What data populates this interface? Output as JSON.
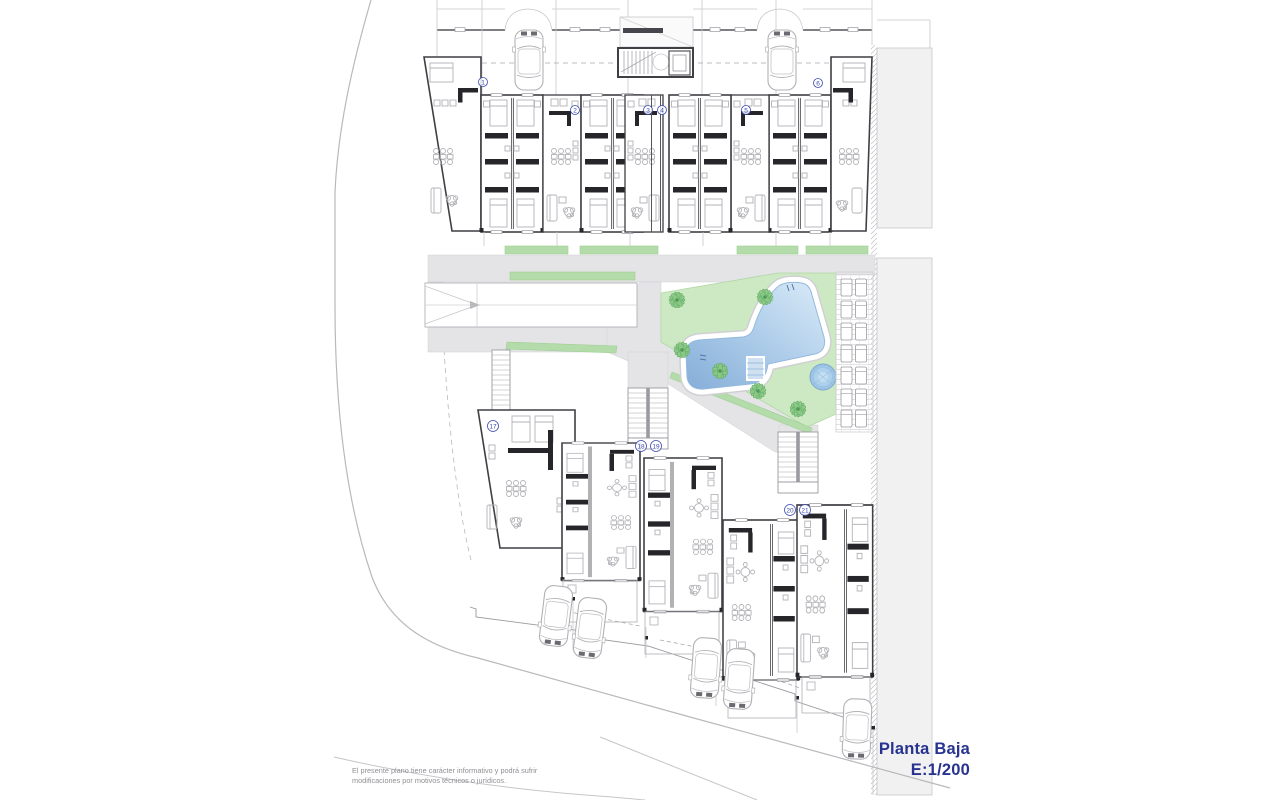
{
  "plan": {
    "type": "architectural-site-plan",
    "title": "Planta Baja",
    "scale": "E:1/200",
    "disclaimer": [
      "El presente plano tiene carácter informativo y podrá sufrir",
      "modificaciones por motivos técnicos o jurídicos."
    ],
    "unit_markers": [
      {
        "label": "1",
        "x": 483,
        "y": 82
      },
      {
        "label": "2",
        "x": 575,
        "y": 110
      },
      {
        "label": "3",
        "x": 648,
        "y": 110
      },
      {
        "label": "4",
        "x": 662,
        "y": 110
      },
      {
        "label": "5",
        "x": 746,
        "y": 110
      },
      {
        "label": "6",
        "x": 818,
        "y": 83
      },
      {
        "label": "17",
        "x": 493,
        "y": 426
      },
      {
        "label": "18",
        "x": 641,
        "y": 446
      },
      {
        "label": "19",
        "x": 656,
        "y": 446
      },
      {
        "label": "20",
        "x": 790,
        "y": 510
      },
      {
        "label": "21",
        "x": 805,
        "y": 510
      }
    ],
    "features": [
      "swimming-pool",
      "spa",
      "garden-lawn",
      "palm-trees",
      "access-ramp",
      "stairs",
      "sun-deck",
      "parking",
      "street"
    ],
    "colors": {
      "pool_light": "#d9ebf8",
      "pool_dark": "#85aed8",
      "spa": "#9cc4e4",
      "lawn": "#cde9c3",
      "hedge": "#b4dcaa",
      "palm": "#8cc98a",
      "path": "#e4e4e7",
      "wall": "#3f3f44",
      "marker_blue": "#3a49b0",
      "title_navy": "#27338f"
    }
  }
}
